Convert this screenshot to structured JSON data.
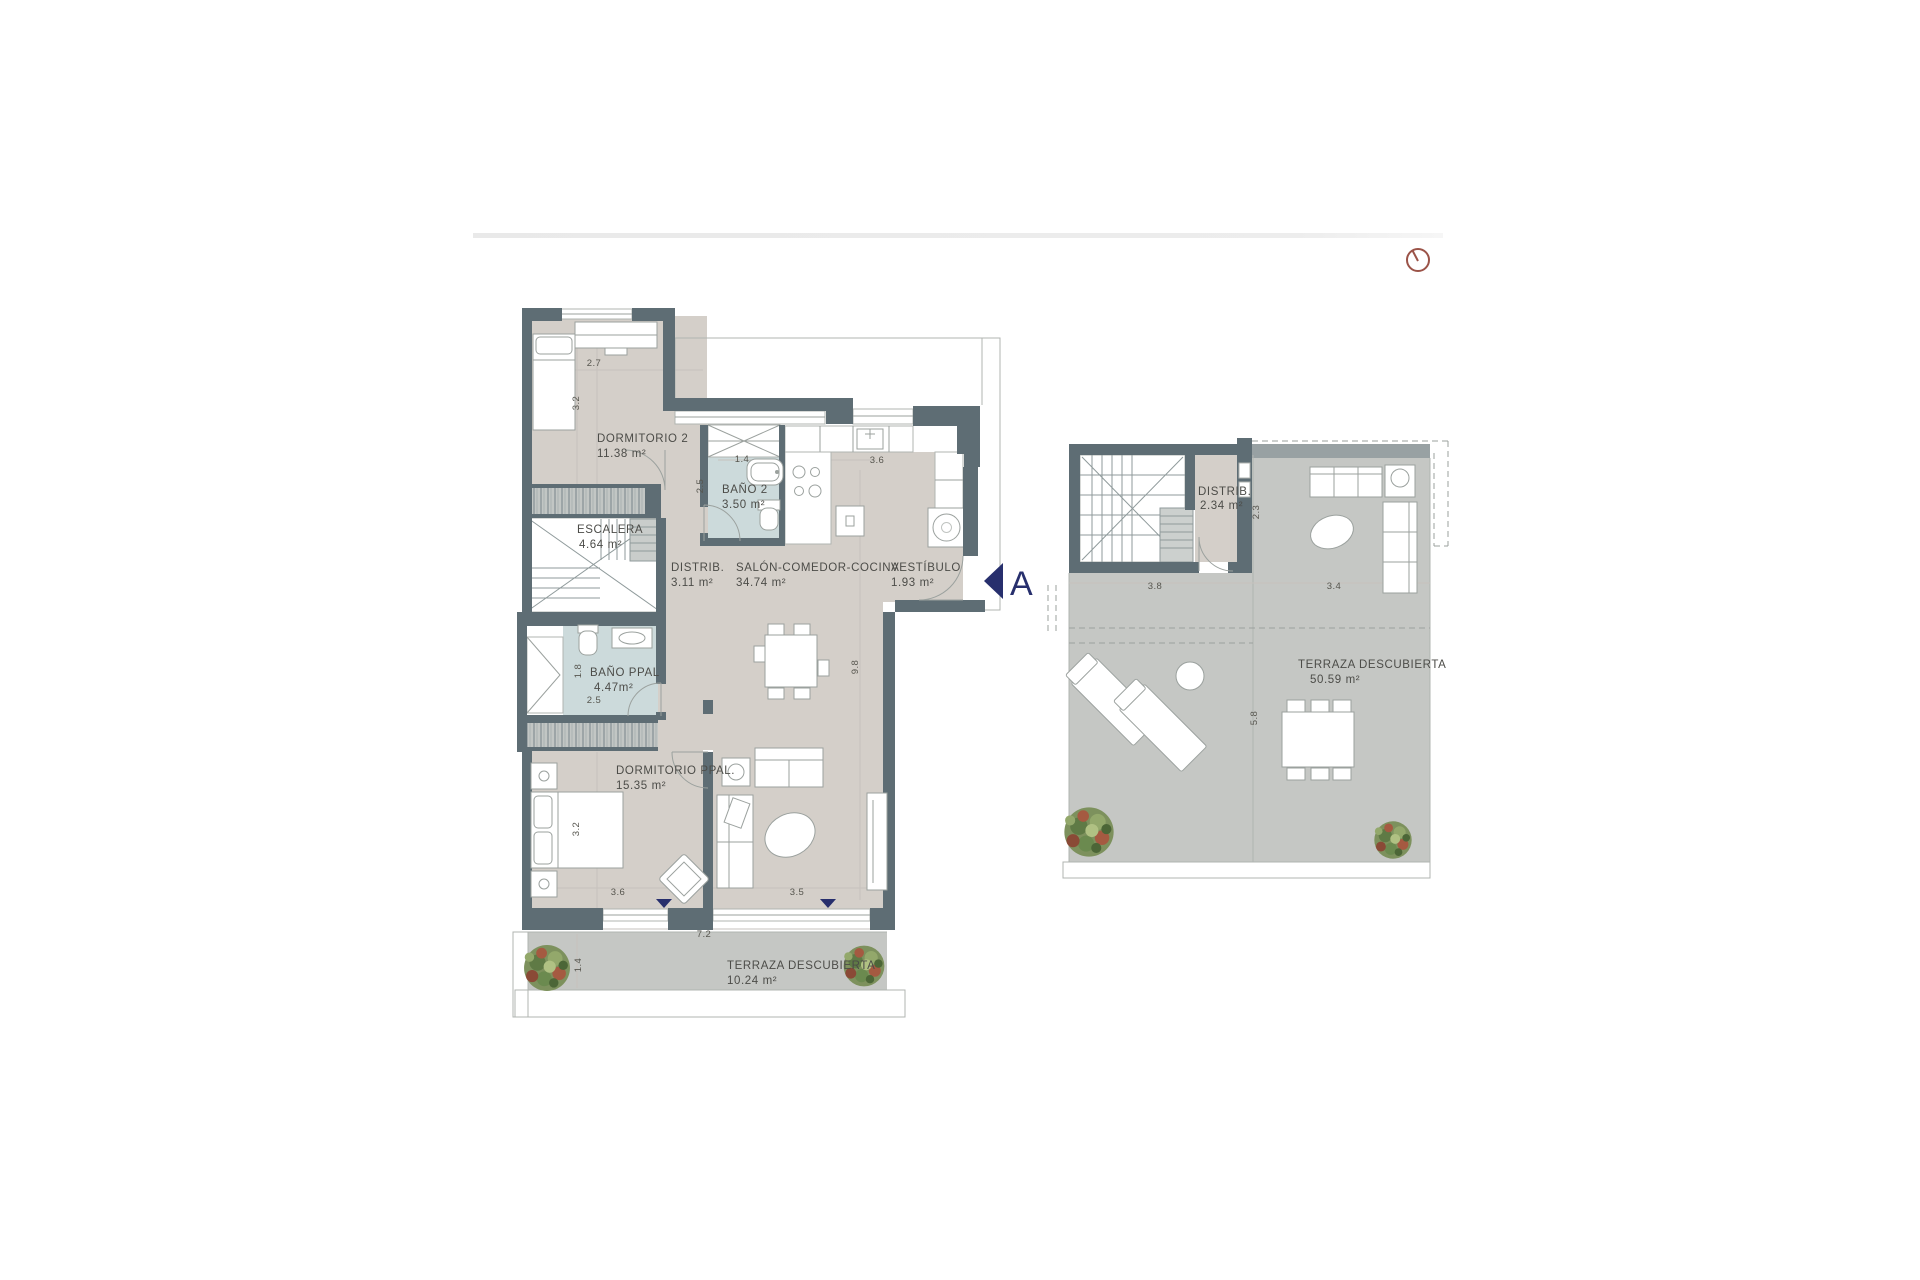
{
  "plan": {
    "marker": {
      "label": "A"
    },
    "main": {
      "rooms": {
        "dorm2": {
          "name": "DORMITORIO 2",
          "area": "11.38 m²"
        },
        "bano2": {
          "name": "BAÑO 2",
          "area": "3.50 m²"
        },
        "escalera": {
          "name": "ESCALERA",
          "area": "4.64 m²"
        },
        "distrib": {
          "name": "DISTRIB.",
          "area": "3.11 m²"
        },
        "salon": {
          "name": "SALÓN-COMEDOR-COCINA",
          "area": "34.74 m²"
        },
        "vestibulo": {
          "name": "VESTÍBULO",
          "area": "1.93 m²"
        },
        "banoppal": {
          "name": "BAÑO PPAL",
          "area": "4.47m²"
        },
        "dormppal": {
          "name": "DORMITORIO PPAL.",
          "area": "15.35 m²"
        },
        "terraza": {
          "name": "TERRAZA DESCUBIERTA",
          "area": "10.24 m²"
        }
      },
      "dims": {
        "dorm2_w": "2.7",
        "dorm2_h": "3.2",
        "bano2_w": "1.4",
        "bano2_h": "2.5",
        "cocina_w": "3.6",
        "salon_h": "9.8",
        "banoppal_h": "1.8",
        "banoppal_w": "2.5",
        "dormppal_h": "3.2",
        "dormppal_w": "3.6",
        "salon_w": "3.5",
        "terraza_w": "7.2",
        "terraza_h": "1.4"
      }
    },
    "roof": {
      "rooms": {
        "distrib": {
          "name": "DISTRIB.",
          "area": "2.34 m²"
        },
        "terraza": {
          "name": "TERRAZA DESCUBIERTA",
          "area": "50.59 m²"
        }
      },
      "dims": {
        "left_w": "3.8",
        "right_w": "3.4",
        "distrib_h": "2.3",
        "terraza_h": "5.8"
      }
    },
    "colors": {
      "wall": "#5e6d74",
      "floor": "#d4cfc9",
      "bath": "#ccdadb",
      "terrace": "#c5c7c4",
      "marker_navy": "#272f6d",
      "clock_maroon": "#9b5348"
    }
  }
}
